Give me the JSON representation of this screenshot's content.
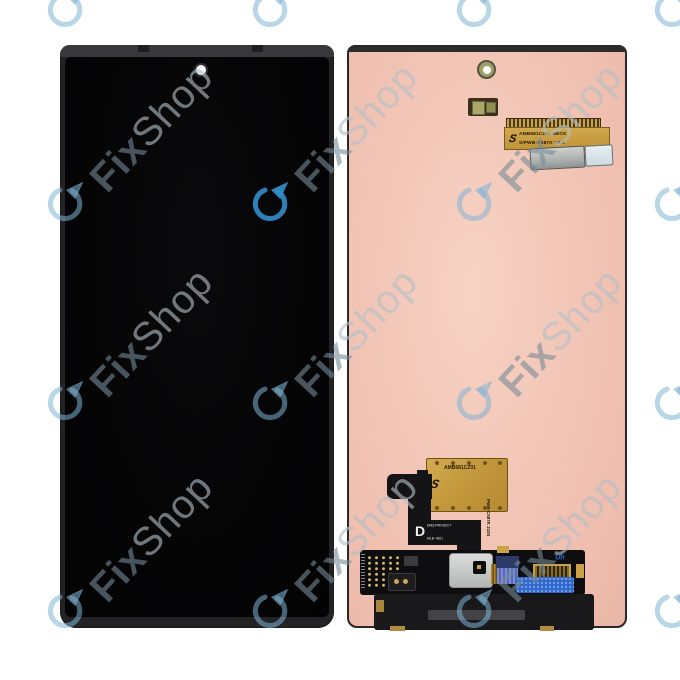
{
  "image_type": "product-photo",
  "subject": "Smartphone OLED display assembly, front and back view",
  "watermark": {
    "fix": "Fix",
    "shop": "Shop",
    "logo": "circular-arrow-logo"
  },
  "labels": {
    "top_flex": {
      "line1": "AMB681CZ01 NECK",
      "line2": "S/PWB-C587K V0.2",
      "logo_glyph": "S"
    },
    "mid_label": {
      "part_number": "AMB681CZ01",
      "side_text": "PWB-C587K 2104",
      "logo_glyph": "S"
    },
    "flex_marking": {
      "letter": "D",
      "line1": "DM3-PROJECT",
      "line2": "MLB +B01",
      "line3": "SCP1B22"
    },
    "pcb_logo_text": "Uh"
  },
  "colors": {
    "background": "#ffffff",
    "screen_black": "#050506",
    "back_panel_pink": "#f2c6b7",
    "flex_gold": "#c79f45",
    "watermark_blue": "#7db4dc",
    "shield_silver": "#c4c8c6",
    "connector_blue": "#2f66c9"
  }
}
